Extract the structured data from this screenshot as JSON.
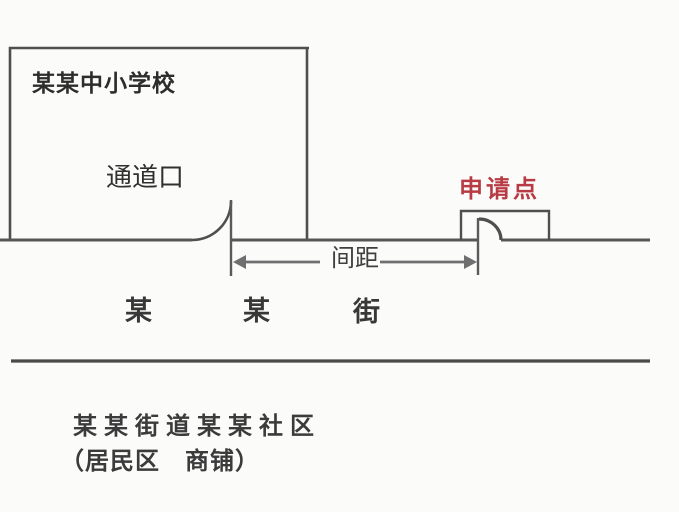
{
  "school": {
    "name": "某某中小学校",
    "gate_label": "通道口"
  },
  "applicant": {
    "label": "申请点",
    "color": "#b83b43"
  },
  "dimension": {
    "label": "间距"
  },
  "street": {
    "name_chars": [
      "某",
      "某",
      "街"
    ]
  },
  "community": {
    "line1": "某某街道某某社区",
    "line2": "（居民区　商铺）"
  },
  "colors": {
    "line": "#4f4f4f",
    "arrow": "#6f6f6f",
    "accent_red": "#b83b43",
    "background": "#fbfbfa"
  }
}
